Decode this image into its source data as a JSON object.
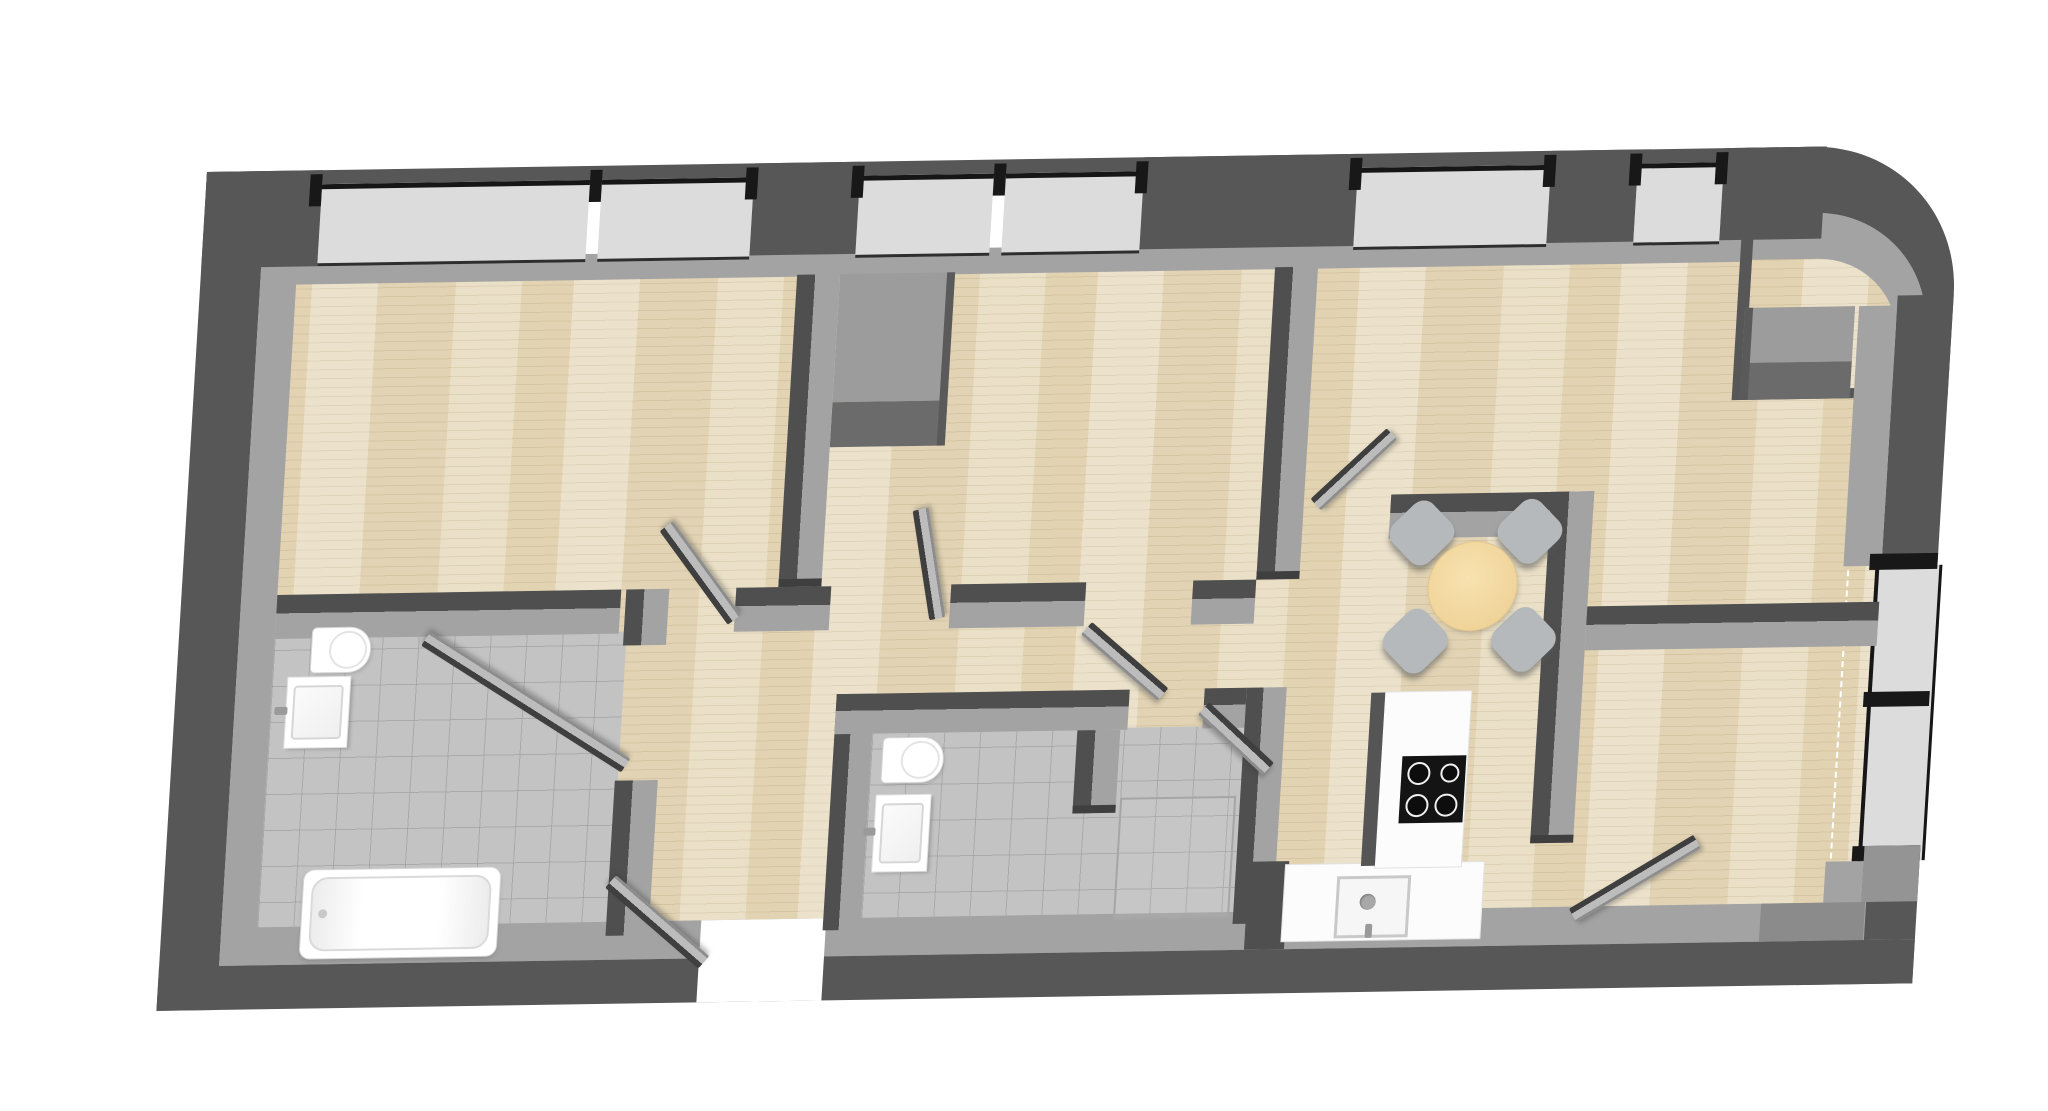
{
  "scene": {
    "type": "3d-floor-plan-render",
    "view": "top-down isometric, slight left-leaning skew",
    "background": "#ffffff",
    "text_labels": []
  },
  "palette": {
    "wall_dark": "#575757",
    "wall_face": "#6e6e6e",
    "wall_top": "#a3a3a3",
    "glass": "#dcdcdc",
    "window_frame": "#181818",
    "wood_floor": "#e8ddc2",
    "tile_floor": "#c3c3c3",
    "fixture_white": "#ffffff",
    "table_wood": "#f0d49a",
    "chair_gray": "#b5b9bc"
  },
  "rooms": [
    {
      "name": "bedroom-top-left",
      "floor": "wood",
      "features": [
        "two top windows"
      ]
    },
    {
      "name": "bedroom-middle",
      "floor": "wood",
      "features": [
        "top windows",
        "chimney block top-left"
      ]
    },
    {
      "name": "living-room-top-right",
      "floor": "wood",
      "features": [
        "top windows",
        "rounded outer corner",
        "chimney block at right wall"
      ]
    },
    {
      "name": "bathroom-left",
      "floor": "tile",
      "fixtures": [
        "toilet",
        "washbasin",
        "bathtub"
      ]
    },
    {
      "name": "wc-middle",
      "floor": "tile",
      "fixtures": [
        "toilet",
        "washbasin",
        "shower"
      ]
    },
    {
      "name": "hallway",
      "floor": "wood",
      "features": [
        "entrance door at bottom"
      ]
    },
    {
      "name": "kitchen-dining",
      "floor": "wood",
      "fixtures": [
        "L-shaped counter",
        "cooktop 4 burners",
        "kitchen sink",
        "round dining table",
        "4 chairs"
      ]
    },
    {
      "name": "room-bottom-right",
      "floor": "wood",
      "features": [
        "tall balcony window on right wall"
      ]
    }
  ],
  "openings": {
    "top_windows": 6,
    "right_balcony_window_panes": 2,
    "interior_door_leaves": 7,
    "entrance_door_leaves": 1
  },
  "counts": {
    "chairs": 4,
    "burners": 4,
    "toilets": 2,
    "washbasins": 2,
    "bathtubs": 1,
    "showers": 1,
    "dining_tables": 1
  }
}
